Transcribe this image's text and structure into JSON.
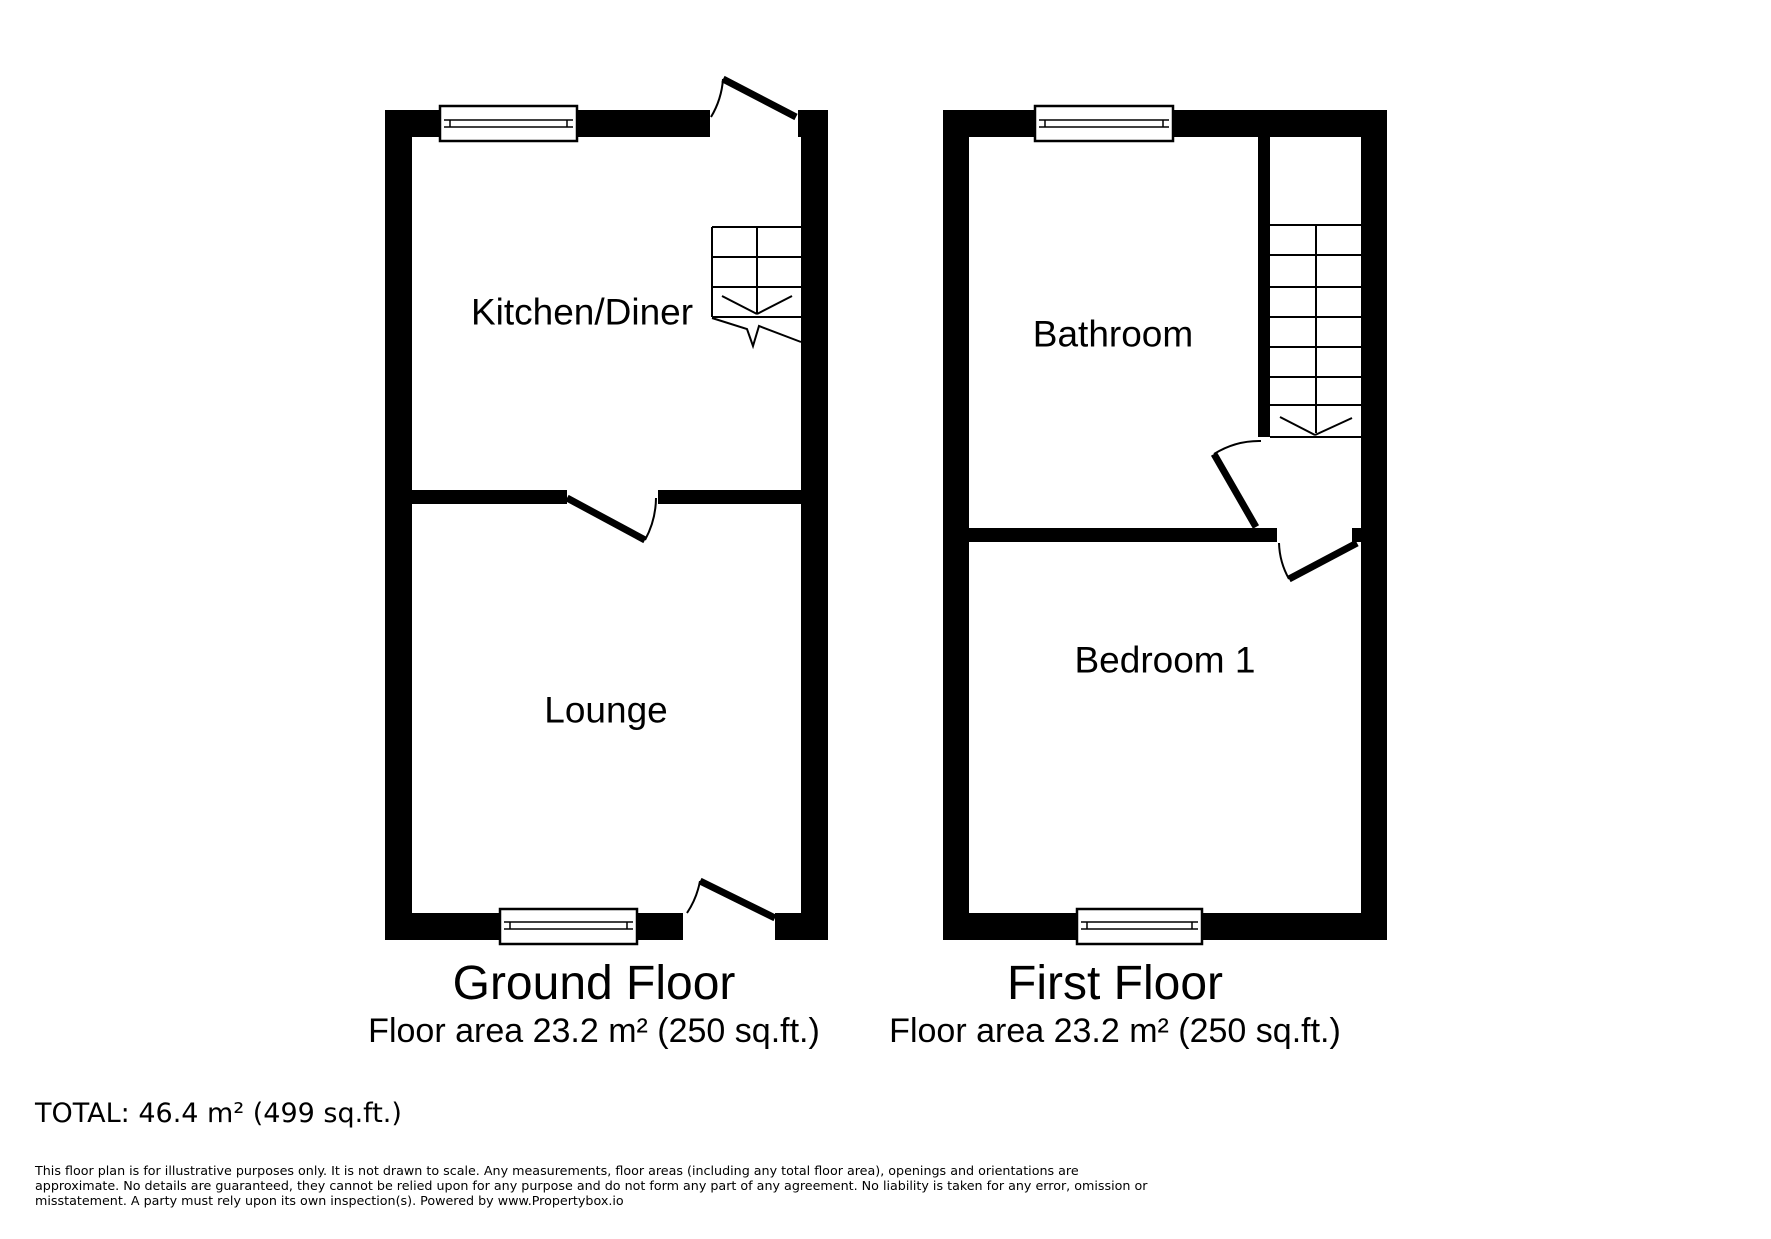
{
  "page": {
    "background_color": "#ffffff",
    "wall_color": "#000000"
  },
  "ground_floor": {
    "title": "Ground Floor",
    "area_text": "Floor area 23.2 m² (250 sq.ft.)",
    "rooms": [
      {
        "label": "Kitchen/Diner"
      },
      {
        "label": "Lounge"
      }
    ]
  },
  "first_floor": {
    "title": "First Floor",
    "area_text": "Floor area 23.2 m² (250 sq.ft.)",
    "rooms": [
      {
        "label": "Bathroom"
      },
      {
        "label": "Bedroom 1"
      }
    ]
  },
  "summary": {
    "total_text": "TOTAL: 46.4 m² (499 sq.ft.)"
  },
  "disclaimer": {
    "lines": [
      "This floor plan is for illustrative purposes only. It is not drawn to scale. Any measurements, floor areas (including any total floor area), openings and orientations are",
      "approximate. No details are guaranteed, they cannot be relied upon for any purpose and do not form any part of any agreement. No liability is taken for any error, omission or",
      "misstatement. A party must rely upon its own inspection(s). Powered by www.Propertybox.io"
    ]
  }
}
